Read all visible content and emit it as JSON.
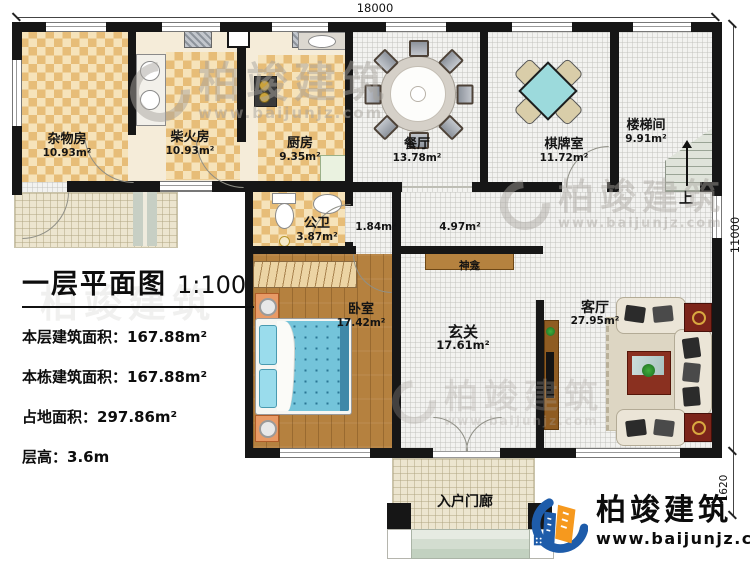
{
  "dimensions": {
    "width_label": "18000",
    "height_label": "11000",
    "porch_label": "1620"
  },
  "title_block": {
    "title": "一层平面图",
    "scale": "1:100",
    "info": [
      {
        "label": "本层建筑面积：",
        "value": "167.88m²"
      },
      {
        "label": "本栋建筑面积：",
        "value": "167.88m²"
      },
      {
        "label": "占地面积：",
        "value": "297.86m²"
      },
      {
        "label": "层高：",
        "value": "3.6m"
      }
    ]
  },
  "rooms": [
    {
      "name": "杂物房",
      "area": "10.93m²"
    },
    {
      "name": "柴火房",
      "area": "10.93m²"
    },
    {
      "name": "厨房",
      "area": "9.35m²"
    },
    {
      "name": "餐厅",
      "area": "13.78m²"
    },
    {
      "name": "棋牌室",
      "area": "11.72m²"
    },
    {
      "name": "楼梯间",
      "area": "9.91m²"
    },
    {
      "name": "公卫",
      "area": "3.87m²"
    },
    {
      "name": "卧室",
      "area": "17.42m²"
    },
    {
      "name": "玄关",
      "area": "17.61m²"
    },
    {
      "name": "客厅",
      "area": "27.95m²"
    }
  ],
  "halls": [
    {
      "area": "1.84m²"
    },
    {
      "area": "4.97m²"
    }
  ],
  "features": {
    "shrine": "神龛",
    "porch": "入户门廊",
    "stairs_up": "上"
  },
  "branding": {
    "company": "柏竣建筑",
    "website": "www.baijunjz.com"
  },
  "colors": {
    "wall": "#161616",
    "checker_dark": "#e7bd78",
    "checker_light": "#f6e3ba",
    "wood_floor": "#b5813f",
    "bed_blue": "#74c4da",
    "game_table_teal": "#9cdadc",
    "shrine_brown": "#b5823f",
    "logo_blue": "#1e5caa",
    "logo_orange": "#f6991e"
  }
}
